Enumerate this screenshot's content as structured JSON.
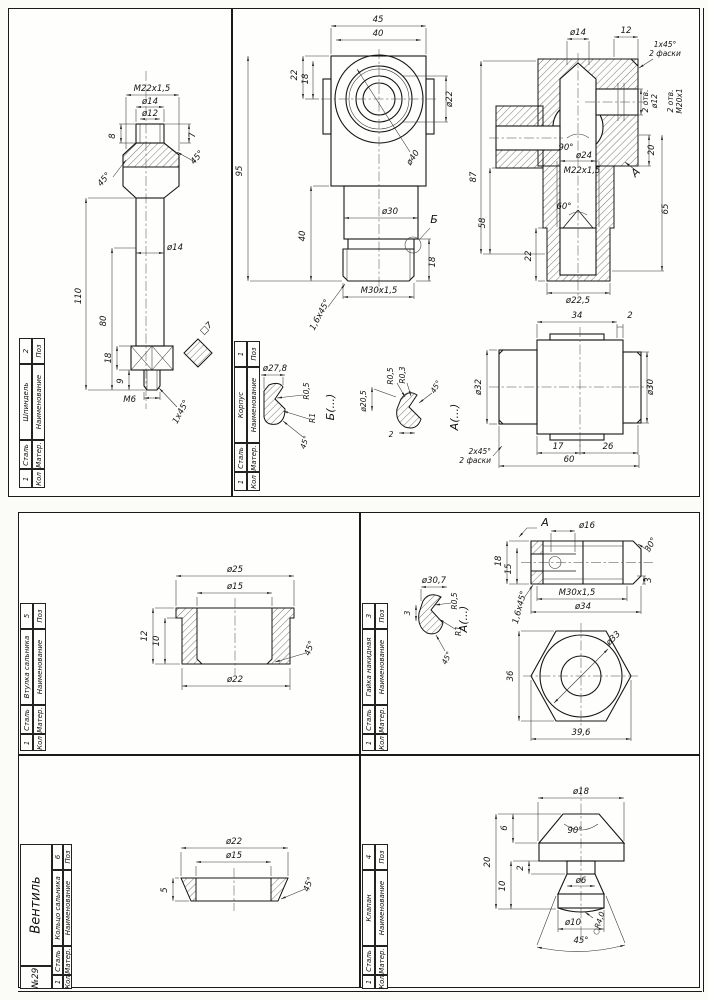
{
  "sheet": {
    "number": "№29",
    "assembly": "Вентиль"
  },
  "tb": {
    "pos": "Поз",
    "name": "Наименование",
    "mater": "Матер.",
    "qty": "Кол"
  },
  "parts": {
    "spindle": {
      "pos": "2",
      "name": "Шпиндель",
      "mater": "Сталь",
      "qty": "1"
    },
    "body": {
      "pos": "1",
      "name": "Корпус",
      "mater": "Сталь",
      "qty": "1"
    },
    "bushing": {
      "pos": "5",
      "name": "Втулка сальника",
      "mater": "Сталь",
      "qty": "1"
    },
    "capnut": {
      "pos": "3",
      "name": "Гайка накидная",
      "mater": "Сталь",
      "qty": "1"
    },
    "ring": {
      "pos": "6",
      "name": "Кольцо сальника",
      "mater": "Сталь",
      "qty": "1"
    },
    "valve": {
      "pos": "4",
      "name": "Клапан",
      "mater": "Сталь",
      "qty": "1"
    }
  },
  "spindle": {
    "m22": "M22x1,5",
    "d14a": "ø14",
    "d12": "ø12",
    "h8": "8",
    "h7": "7",
    "a45l": "45°",
    "a45r": "45°",
    "l110": "110",
    "l80": "80",
    "d14b": "ø14",
    "h18": "18",
    "h9": "9",
    "m6": "M6",
    "ch1x45": "1x45°",
    "sq7": "□7"
  },
  "body_front": {
    "w45": "45",
    "w40": "40",
    "h22": "22",
    "h18": "18",
    "d22": "ø22",
    "d40": "ø40",
    "h95": "95",
    "d30": "ø30",
    "h40": "40",
    "h18b": "18",
    "b": "Б",
    "m30": "M30x1,5",
    "ch16": "1,6x45°"
  },
  "body_sec": {
    "d14": "ø14",
    "w12": "12",
    "ch1": "1x45°",
    "ch1b": "2 фаски",
    "m20": "M20x1",
    "m20b": "2 отв.",
    "d12": "ø12",
    "d12b": "2 отв.",
    "a90": "90°",
    "d24": "ø24",
    "m22": "M22x1,5",
    "a": "А",
    "h20": "20",
    "h65": "65",
    "h87": "87",
    "h58": "58",
    "a60": "60°",
    "h22": "22",
    "d225": "ø22,5"
  },
  "body_side": {
    "w34": "34",
    "w2": "2",
    "d32": "ø32",
    "d30": "ø30",
    "w17": "17",
    "w26": "26",
    "w60": "60",
    "ch2": "2x45°",
    "ch2b": "2 фаски"
  },
  "body_db": {
    "t": "Б(...)",
    "d278": "ø27,8",
    "h25": "2,5",
    "r05": "R0,5",
    "r1": "R1",
    "a45": "45°"
  },
  "body_da": {
    "t": "А(...)",
    "d205": "ø20,5",
    "r03": "R0,3",
    "r05": "R0,5",
    "w2": "2",
    "a45": "45°"
  },
  "bushing_d": {
    "d25": "ø25",
    "d15": "ø15",
    "h12": "12",
    "h10": "10",
    "d22": "ø22",
    "a45": "45°"
  },
  "capnut_d": {
    "a": "А",
    "d16": "ø16",
    "h18": "18",
    "h15": "15",
    "ch16": "1,6x45°",
    "m30": "M30x1,5",
    "d34": "ø34",
    "a30": "30°",
    "h3": "3",
    "s36": "36",
    "d33": "ø33",
    "s396": "39,6"
  },
  "capnut_da": {
    "t": "А(...)",
    "d307": "ø30,7",
    "r05": "R0,5",
    "r1": "R1",
    "h3": "3",
    "a45": "45°"
  },
  "ring_d": {
    "d22": "ø22",
    "d15": "ø15",
    "h5": "5",
    "a45": "45°"
  },
  "valve_d": {
    "d18": "ø18",
    "a90": "90°",
    "h6": "6",
    "h20": "20",
    "h10": "10",
    "h2": "2",
    "d6": "ø6",
    "d10": "ø10",
    "r4": "○R4,0",
    "a45": "45°"
  }
}
